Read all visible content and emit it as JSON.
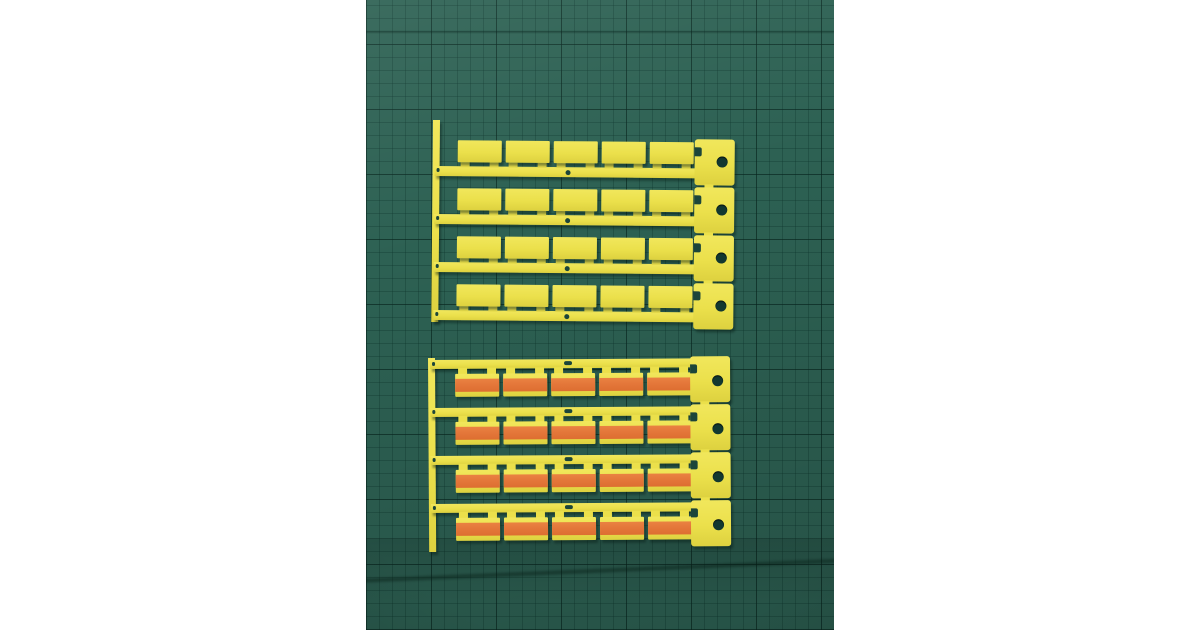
{
  "scene": {
    "type": "photograph",
    "subject": "Two sets of yellow plastic cable-marker tag strips on a dark green self-healing cutting mat, centered between white margins",
    "page_background_color": "#ffffff",
    "mat": {
      "base_color": "#2d6153",
      "grid_minor_color": "rgba(12,52,43,0.33)",
      "grid_major_color": "rgba(8,36,29,0.55)",
      "grid_minor_step_px": 13,
      "grid_major_step_px": 65
    },
    "strips": {
      "plastic_color": "#ebe04b",
      "plastic_highlight": "#f1e75c",
      "plastic_shade": "#ddd13f",
      "stripe_color": "#e4773a",
      "hole_color": "#123830",
      "slot_color": "#1c453a"
    },
    "groups": [
      {
        "id": "plain",
        "label": "blank yellow marker tag strips",
        "strip_count": 4,
        "tags_per_strip": 5,
        "tag_style": "plain"
      },
      {
        "id": "striped",
        "label": "orange-striped marker tag strips",
        "strip_count": 4,
        "tags_per_strip": 5,
        "tag_style": "orange-stripe"
      }
    ]
  }
}
